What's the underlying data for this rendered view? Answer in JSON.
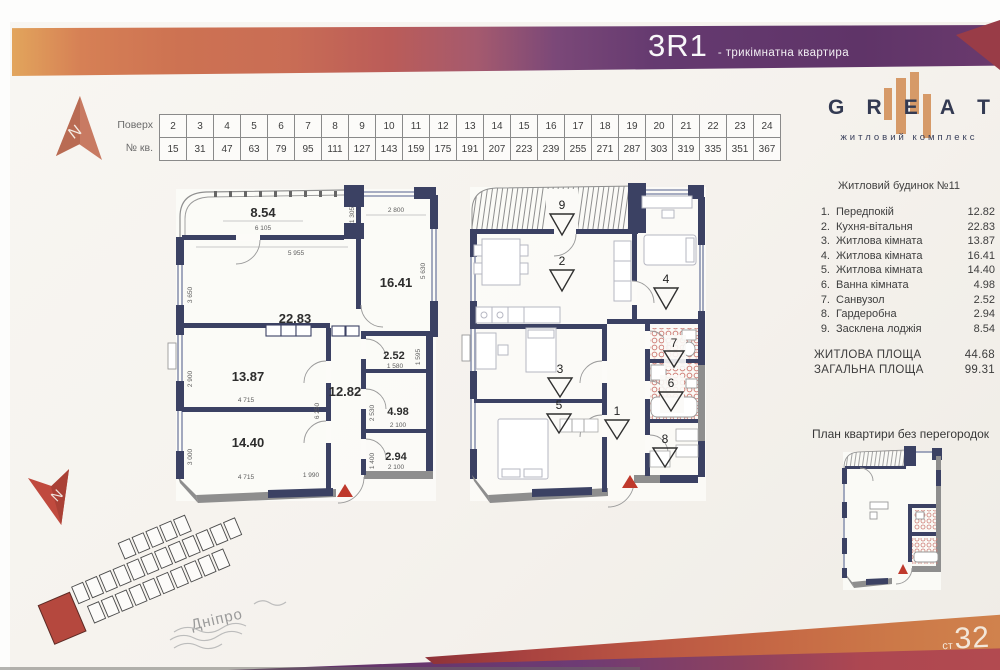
{
  "header": {
    "code": "3R1",
    "subtitle": "- трикімнатна квартира"
  },
  "floors_table": {
    "row1_label": "Поверх",
    "row2_label": "№ кв.",
    "floors": [
      "2",
      "3",
      "4",
      "5",
      "6",
      "7",
      "8",
      "9",
      "10",
      "11",
      "12",
      "13",
      "14",
      "15",
      "16",
      "17",
      "18",
      "19",
      "20",
      "21",
      "22",
      "23",
      "24"
    ],
    "apartments": [
      "15",
      "31",
      "47",
      "63",
      "79",
      "95",
      "111",
      "127",
      "143",
      "159",
      "175",
      "191",
      "207",
      "223",
      "239",
      "255",
      "271",
      "287",
      "303",
      "319",
      "335",
      "351",
      "367"
    ]
  },
  "logo": {
    "letters": [
      "G",
      "R",
      "E",
      "A",
      "T"
    ],
    "subtitle": "житловий комплекс",
    "building": "Житловий будинок №11"
  },
  "legend": {
    "items": [
      {
        "num": "1.",
        "name": "Передпокій",
        "area": "12.82"
      },
      {
        "num": "2.",
        "name": "Кухня-вітальня",
        "area": "22.83"
      },
      {
        "num": "3.",
        "name": "Житлова кімната",
        "area": "13.87"
      },
      {
        "num": "4.",
        "name": "Житлова кімната",
        "area": "16.41"
      },
      {
        "num": "5.",
        "name": "Житлова кімната",
        "area": "14.40"
      },
      {
        "num": "6.",
        "name": "Ванна кімната",
        "area": "4.98"
      },
      {
        "num": "7.",
        "name": "Санвузол",
        "area": "2.52"
      },
      {
        "num": "8.",
        "name": "Гардеробна",
        "area": "2.94"
      },
      {
        "num": "9.",
        "name": "Засклена лоджія",
        "area": "8.54"
      }
    ],
    "totals": [
      {
        "label": "ЖИТЛОВА ПЛОЩА",
        "value": "44.68"
      },
      {
        "label": "ЗАГАЛЬНА ПЛОЩА",
        "value": "99.31"
      }
    ]
  },
  "plan_left": {
    "areas": {
      "loggia": "8.54",
      "kitchen": "22.83",
      "r16": "16.41",
      "r13": "13.87",
      "r14": "14.40",
      "hall": "12.82",
      "wc": "2.52",
      "bath": "4.98",
      "ward": "2.94"
    },
    "dims": {
      "d6105": "6 105",
      "d1305": "1 305",
      "d2800": "2 800",
      "d5955": "5 955",
      "d5630": "5 630",
      "d3650": "3 650",
      "d2900": "2 900",
      "d4715a": "4 715",
      "d3000": "3 000",
      "d4715b": "4 715",
      "d6250": "6 250",
      "d1580": "1 580",
      "d1595": "1 595",
      "d2530": "2 530",
      "d2100a": "2 100",
      "d1400": "1 400",
      "d2100b": "2 100",
      "d1990": "1 990"
    }
  },
  "plan_right": {
    "markers": {
      "m1": "1",
      "m2": "2",
      "m3": "3",
      "m4": "4",
      "m5": "5",
      "m6": "6",
      "m7": "7",
      "m8": "8",
      "m9": "9"
    }
  },
  "no_partitions_title": "План квартири без перегородок",
  "site_plan": {
    "river": "Дніпро"
  },
  "compass": {
    "n1": "N",
    "n2": "N"
  },
  "footer": {
    "prefix": "ст",
    "num": "32"
  }
}
